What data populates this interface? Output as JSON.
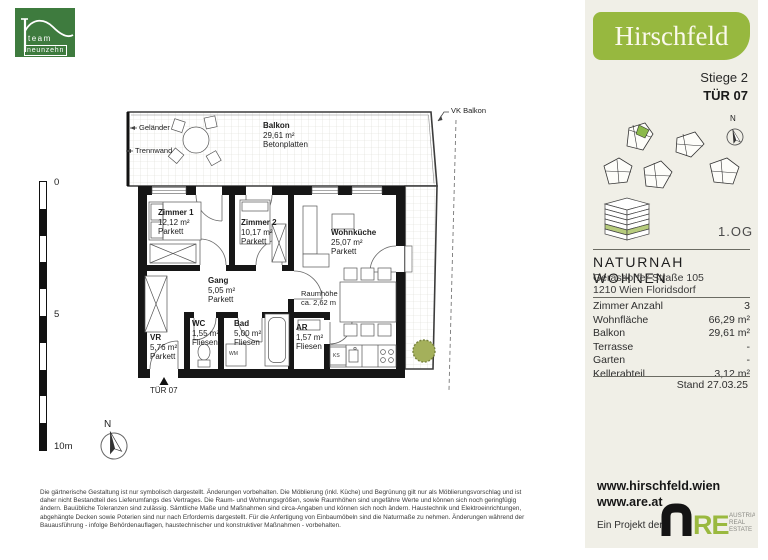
{
  "logo": {
    "line1": "team",
    "line2": "neunzehn"
  },
  "brand": {
    "name": "Hirschfeld",
    "stiege": "Stiege 2",
    "tuer": "TÜR 07"
  },
  "siteplan": {
    "north": "N",
    "floor": "1.OG"
  },
  "info": {
    "project": "NATURNAH WOHNEN",
    "address1": "Gerasdorfer Straße 105",
    "address2": "1210 Wien Floridsdorf",
    "rows": [
      {
        "label": "Zimmer Anzahl",
        "value": "3"
      },
      {
        "label": "Wohnfläche",
        "value": "66,29 m²"
      },
      {
        "label": "Balkon",
        "value": "29,61 m²"
      },
      {
        "label": "Terrasse",
        "value": "-"
      },
      {
        "label": "Garten",
        "value": "-"
      },
      {
        "label": "Kellerabteil",
        "value": "3,12 m²"
      }
    ],
    "stand": "Stand 27.03.25"
  },
  "links": {
    "url1": "www.hirschfeld.wien",
    "url2": "www.are.at",
    "project_note": "Ein Projekt der",
    "are_re": "RE",
    "are_tag1": "AUSTRIAN",
    "are_tag2": "REAL",
    "are_tag3": "ESTATE"
  },
  "plan": {
    "balkon": {
      "name": "Balkon",
      "area": "29,61 m²",
      "note": "Betonplatten"
    },
    "rooms": [
      {
        "name": "Zimmer 1",
        "area": "12,12 m²",
        "floor": "Parkett"
      },
      {
        "name": "Zimmer 2",
        "area": "10,17 m²",
        "floor": "Parkett"
      },
      {
        "name": "Wohnküche",
        "area": "25,07 m²",
        "floor": "Parkett"
      },
      {
        "name": "Gang",
        "area": "5,05 m²",
        "floor": "Parkett"
      },
      {
        "name": "VR",
        "area": "5,76 m²",
        "floor": "Parkett"
      },
      {
        "name": "WC",
        "area": "1,55 m²",
        "floor": "Fliesen"
      },
      {
        "name": "Bad",
        "area": "5,00 m²",
        "floor": "Fliesen"
      },
      {
        "name": "AR",
        "area": "1,57 m²",
        "floor": "Fliesen"
      }
    ],
    "labels": {
      "gelaender": "Geländer",
      "trennwand": "Trennwand",
      "vk_balkon": "VK Balkon",
      "raumhoehe_1": "Raumhöhe",
      "raumhoehe_2": "ca. 2,62 m",
      "tuer": "TÜR 07",
      "north": "N",
      "wm": "WM",
      "ks": "KS"
    },
    "scale": {
      "t0": "0",
      "t5": "5",
      "t10": "10m"
    }
  },
  "disclaimer": [
    "Die gärtnerische Gestaltung ist nur symbolisch dargestellt. Änderungen vorbehalten. Die Möblierung (inkl. Küche) und Begrünung gilt nur als Möblierungsvorschlag und ist",
    "daher nicht Bestandteil des Lieferumfangs des Vertrages. Die Raum- und Wohnungsgrößen, sowie Raumhöhen sind ungefähre Werte und können sich noch geringfügig",
    "ändern. Bauübliche Toleranzen sind zulässig. Sämtliche Maße und Maßnahmen sind circa-Angaben und können sich noch ändern. Haustechnik und Elektroeinrichtungen,",
    "abgehängte Decken sowie Poterien sind nur nach Erfordernis dargestellt. Für die Anfertigung von Einbaumöbeln sind die Naturmaße zu nehmen. Änderungen während der",
    "Bauausführung - infolge Behördenauflagen, haustechnischer und konstruktiver Maßnahmen - vorbehalten."
  ],
  "colors": {
    "brand_green": "#97b83f",
    "logo_green": "#3e7b3e",
    "panel_bg": "#f0efe7",
    "unit_highlight": "#8bb94a",
    "bush_green": "#a4b05b"
  }
}
